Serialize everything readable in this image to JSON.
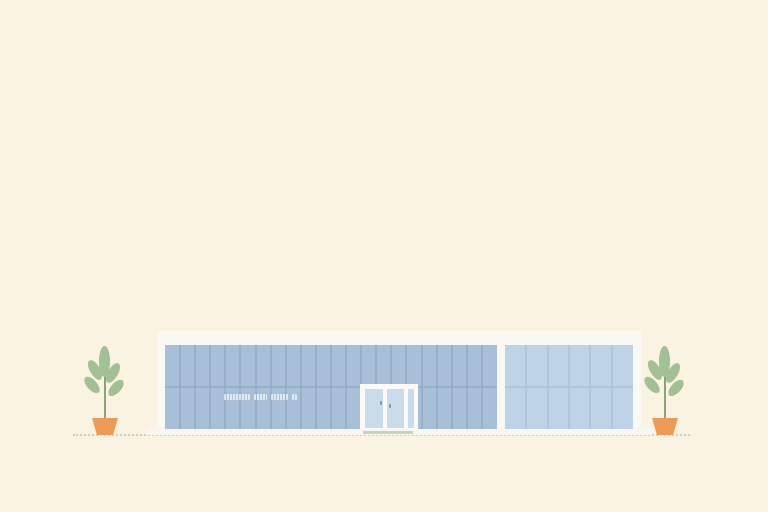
{
  "scene": {
    "description": "Minimal flat illustration of a modern glass storefront building with two potted plants",
    "background_color": "#fbf3e2",
    "ground_line_color": "#beb9a5"
  },
  "building": {
    "frame_color": "#f9f8f3",
    "base_slab_color": "#f7f6f0",
    "left_glass": {
      "color": "#a8bfd8",
      "mullion_color": "#94abc6",
      "panel_count": 22
    },
    "right_glass": {
      "color": "#bfd3e7",
      "mullion_color": "#aac3dc",
      "panel_count": 6
    },
    "door": {
      "frame_color": "#fbfaf6",
      "glass_color": "#cadbeb",
      "handle_color": "#8b94a3",
      "mat_color": "#c8d2b9"
    },
    "sign": {
      "legible": false,
      "segments_px": [
        26,
        13,
        17,
        5
      ]
    }
  },
  "plants": {
    "count": 2,
    "leaf_color": "#a3bf94",
    "stem_color": "#84a877",
    "pot_color": "#ec9a57"
  }
}
